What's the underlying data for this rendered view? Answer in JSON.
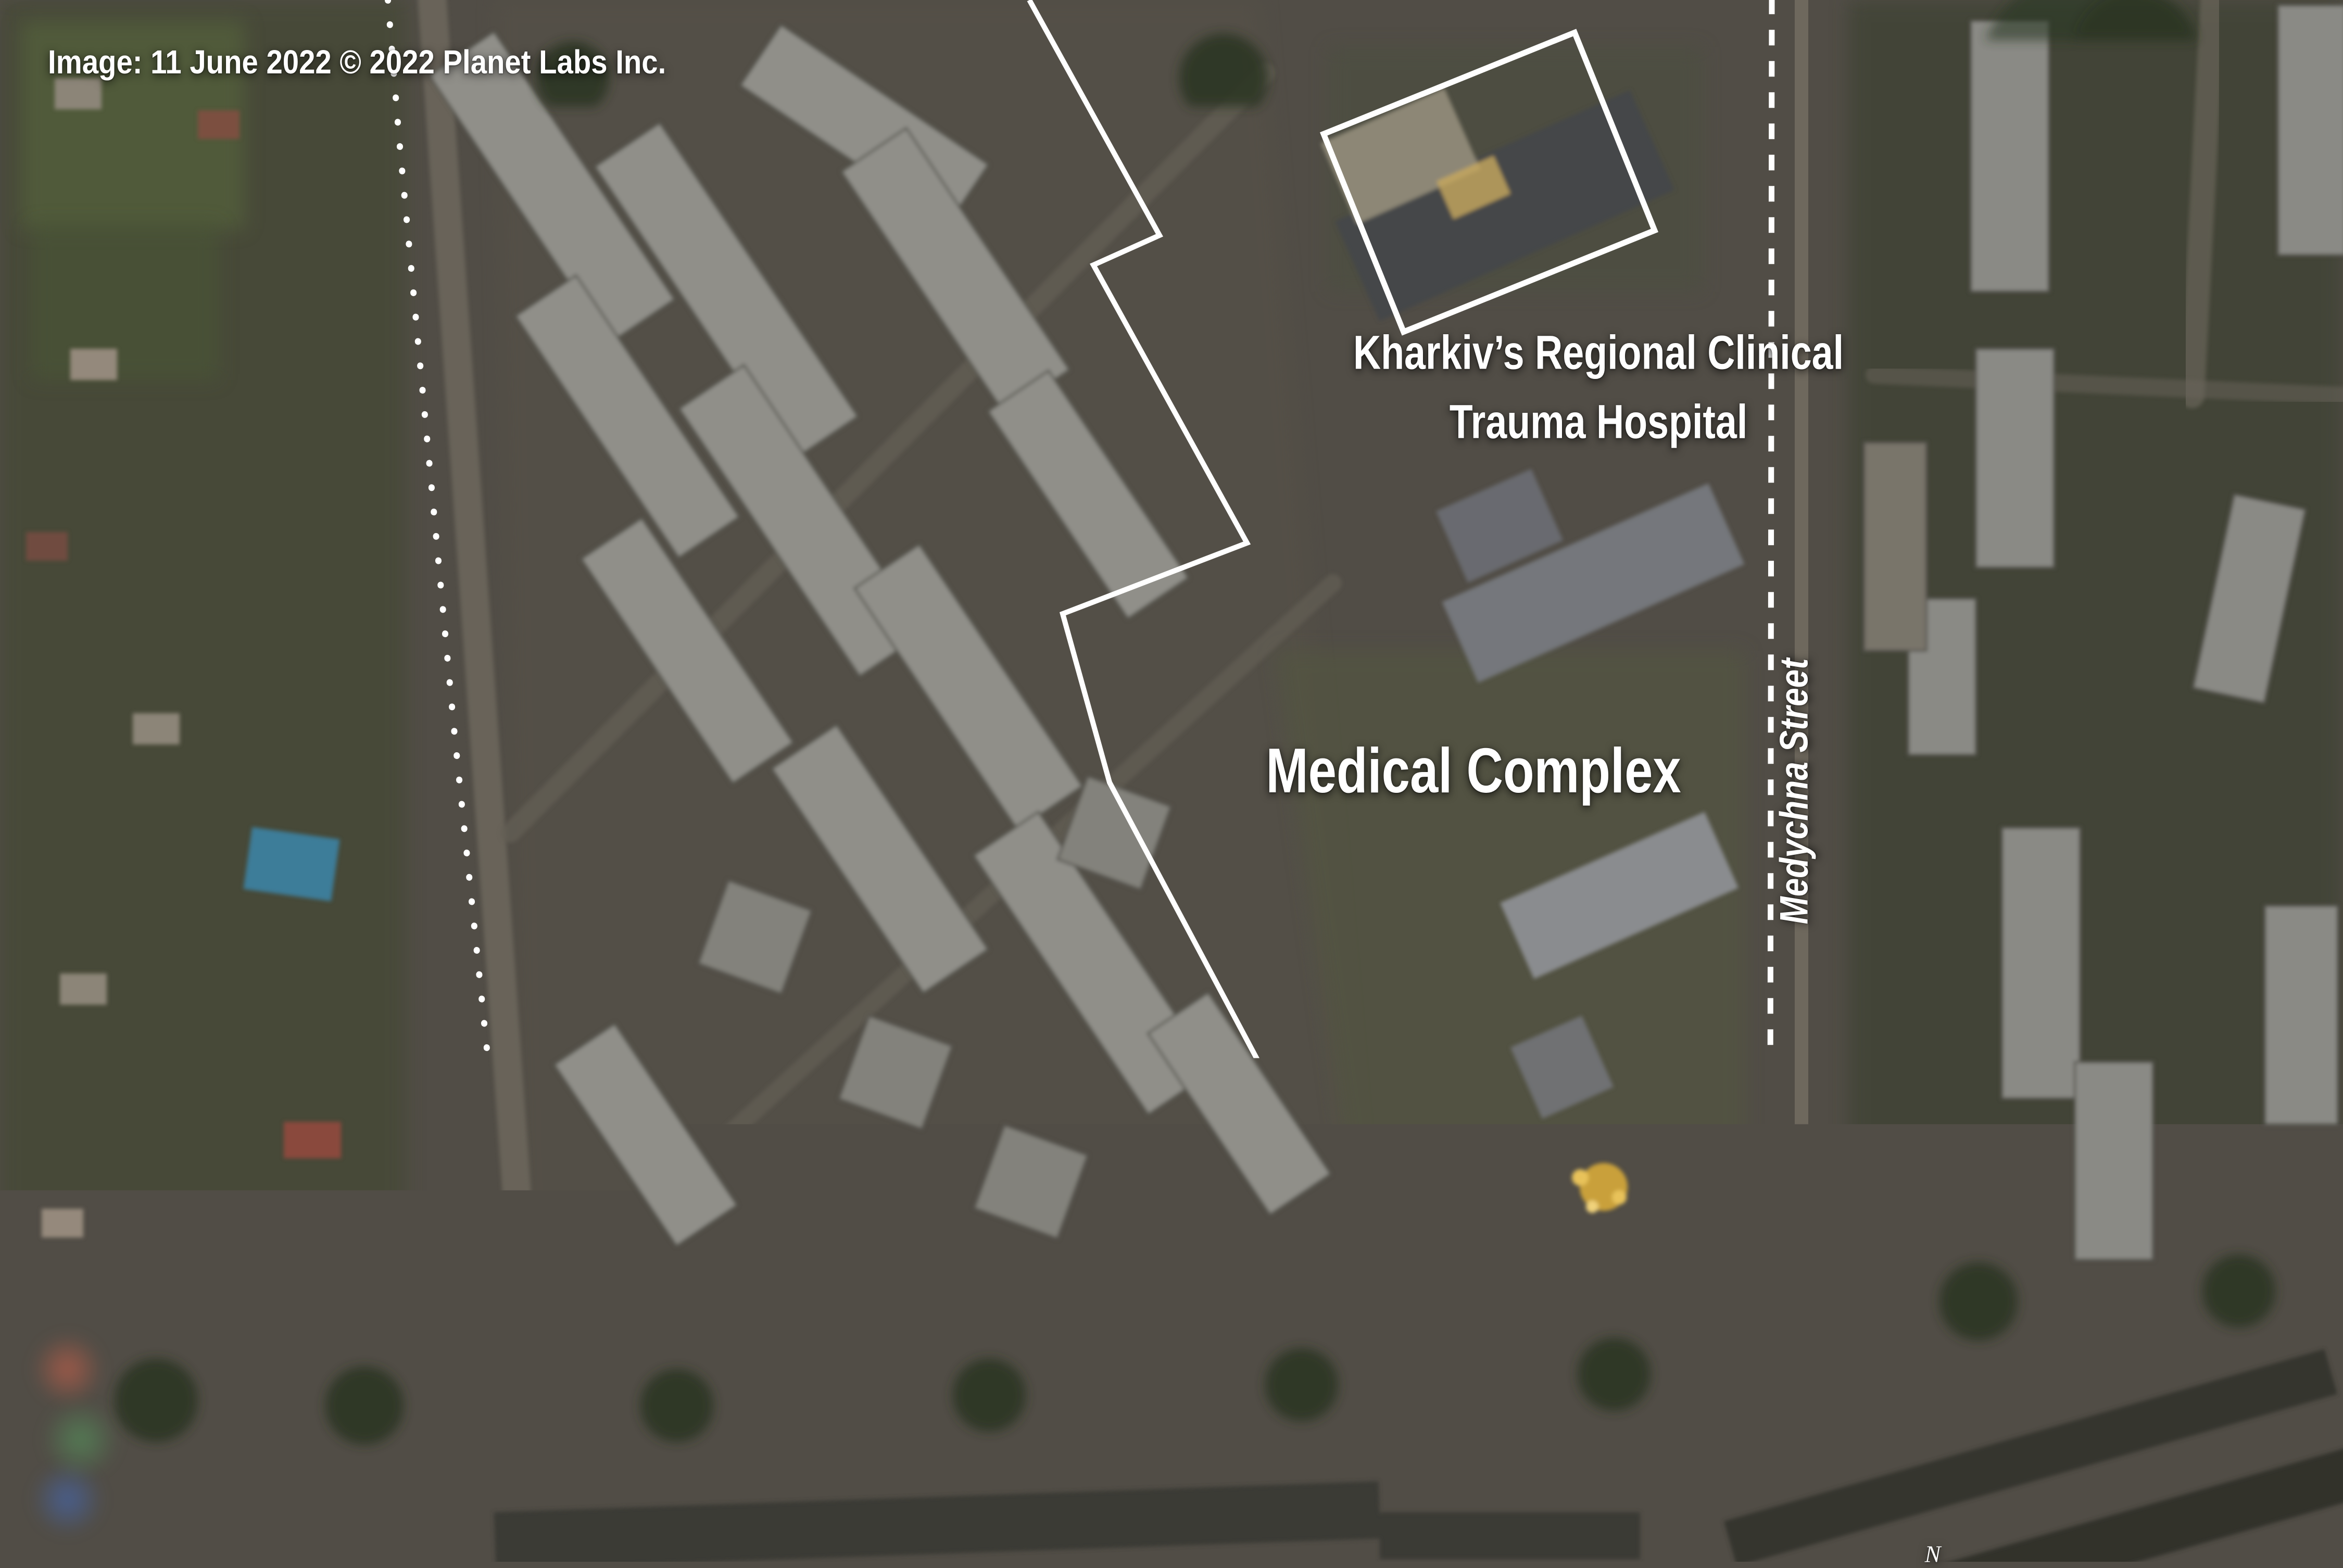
{
  "image_meta": {
    "credit": "Image: 11 June 2022 © 2022 Planet Labs Inc."
  },
  "labels": {
    "hospital": {
      "line1": "Kharkiv’s Regional Clinical",
      "line2": "Trauma Hospital"
    },
    "medical_complex": "Medical Complex",
    "medychna_street": "Medychna Street",
    "earthen_berms": "Earthen berms",
    "roadblocks": "Roadblocks",
    "saltivske_highway": "Saltivske Highway"
  },
  "scale_bar": {
    "distance": "70",
    "unit": "Meters"
  },
  "compass": {
    "north_label": "N"
  },
  "colors": {
    "annotation_orange": "#F6A31C",
    "annotation_white": "#FFFFFF"
  }
}
